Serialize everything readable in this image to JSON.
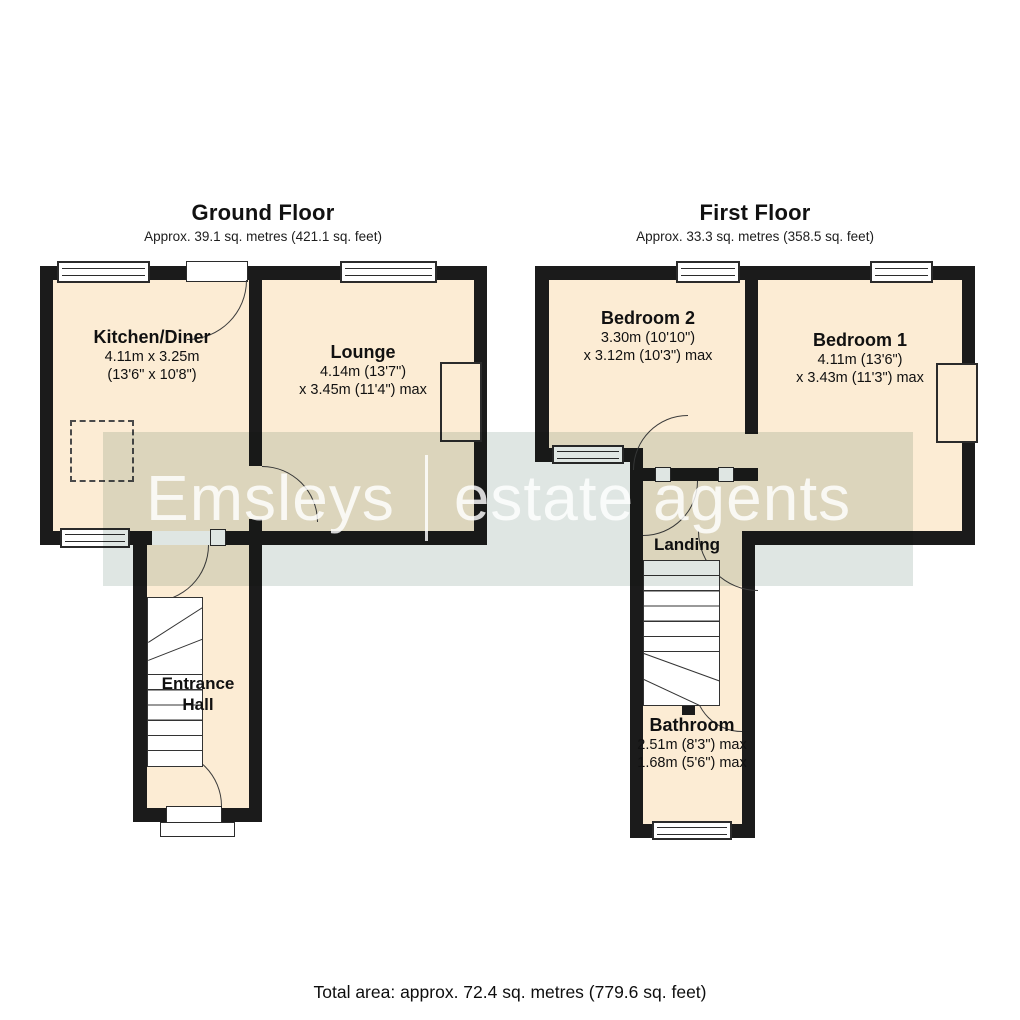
{
  "ground_floor": {
    "title": "Ground Floor",
    "area": "Approx. 39.1 sq. metres (421.1 sq. feet)",
    "rooms": {
      "kitchen": {
        "name": "Kitchen/Diner",
        "dim1": "4.11m x 3.25m",
        "dim2": "(13'6\" x 10'8\")"
      },
      "lounge": {
        "name": "Lounge",
        "dim1": "4.14m (13'7\")",
        "dim2": "x 3.45m (11'4\") max"
      },
      "hall": {
        "name": "Entrance Hall"
      }
    }
  },
  "first_floor": {
    "title": "First Floor",
    "area": "Approx. 33.3 sq. metres (358.5 sq. feet)",
    "rooms": {
      "bedroom2": {
        "name": "Bedroom 2",
        "dim1": "3.30m (10'10\")",
        "dim2": "x 3.12m (10'3\") max"
      },
      "bedroom1": {
        "name": "Bedroom 1",
        "dim1": "4.11m (13'6\")",
        "dim2": "x 3.43m (11'3\") max"
      },
      "landing": {
        "name": "Landing"
      },
      "bathroom": {
        "name": "Bathroom",
        "dim1": "2.51m (8'3\") max",
        "dim2": "1.68m (5'6\") max"
      }
    }
  },
  "watermark": {
    "brand": "Emsleys",
    "separator": "|",
    "tagline": "estate agents"
  },
  "footer": {
    "total": "Total area: approx. 72.4 sq. metres (779.6 sq. feet)"
  },
  "colors": {
    "room_fill": "#fcecd4",
    "wall": "#1b1b1b",
    "watermark_band": "#dfe6e3",
    "text": "#111111"
  }
}
